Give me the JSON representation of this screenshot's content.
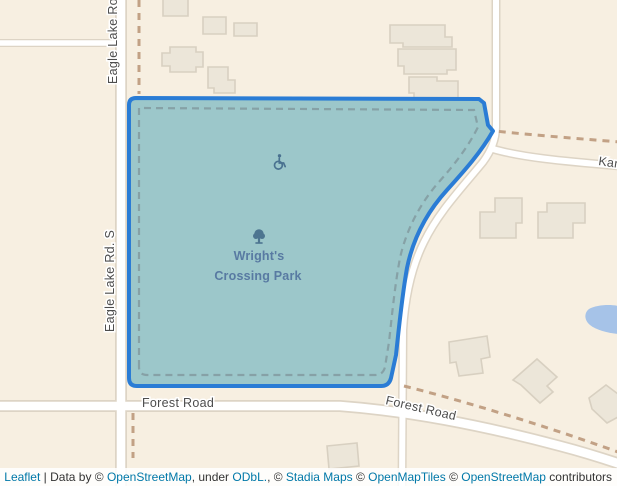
{
  "map": {
    "park": {
      "name_line1": "Wright's",
      "name_line2": "Crossing Park"
    },
    "road_labels": {
      "eagle_lake_top": "Eagle Lake Ro",
      "eagle_lake_s": "Eagle Lake Rd. S",
      "forest_road_west": "Forest Road",
      "forest_road_east": "Forest Road",
      "kam_partial": "Kam"
    },
    "icons": {
      "park_poi": "tree-icon",
      "accessibility_poi": "wheelchair-icon"
    }
  },
  "colors": {
    "land": "#f7efe1",
    "building_fill": "#ece6d9",
    "building_stroke": "#d8d0c1",
    "road_fill": "#ffffff",
    "road_casing": "#ddd4c5",
    "trail_dash": "#c2a185",
    "park_fill": "#9cc7ca",
    "park_stroke": "#2a7cd5",
    "park_inner_dash": "#7f9499",
    "water": "#a6c3e8",
    "road_label_text": "#4d4d4d",
    "park_label_text": "#587aa2",
    "poi_icon_color": "#4a7290",
    "link_blue": "#0078a8",
    "attribution_text": "#333333"
  },
  "attribution": {
    "leaflet": "Leaflet",
    "data_by": " | Data by © ",
    "osm1": "OpenStreetMap",
    "under": ", under ",
    "odbl": "ODbL.",
    "sep1": ", © ",
    "stadia": "Stadia Maps",
    "sep2": " © ",
    "openmaptiles": "OpenMapTiles",
    "sep3": " © ",
    "osm2": "OpenStreetMap",
    "contributors": " contributors"
  }
}
